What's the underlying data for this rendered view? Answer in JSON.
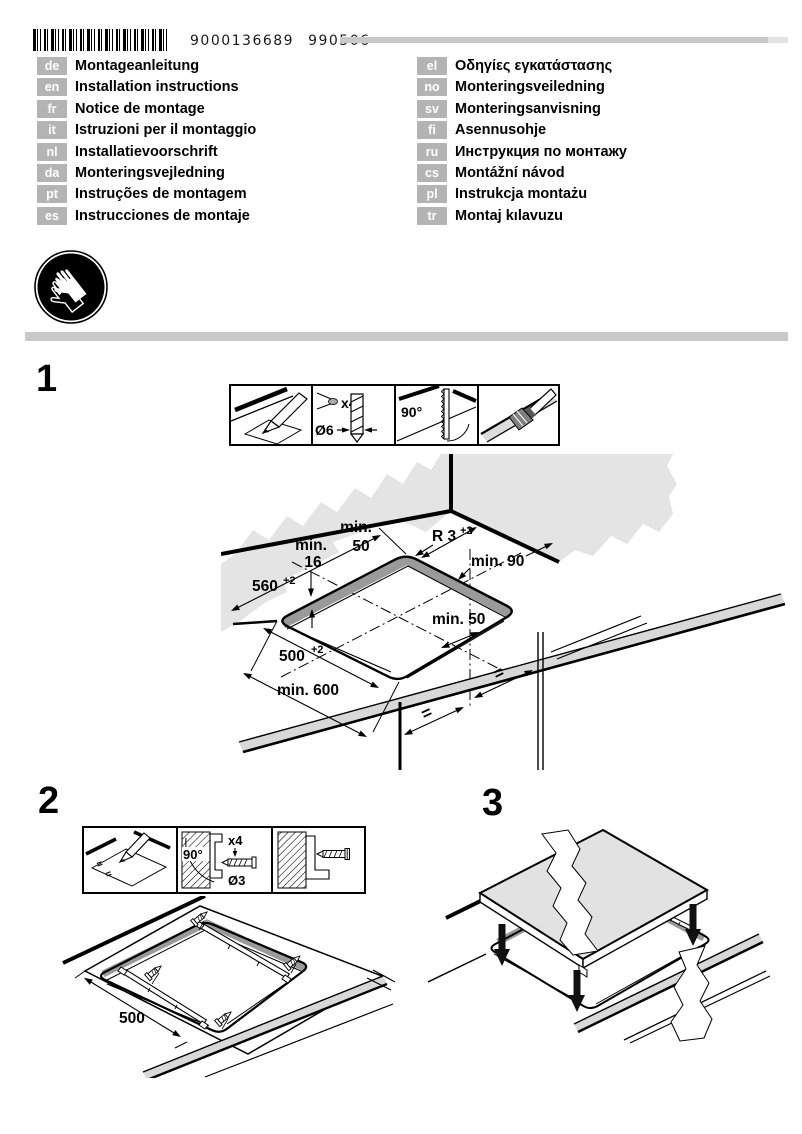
{
  "header": {
    "barcode_number": "9000136689",
    "date_code": "990506",
    "barcode_icon": "barcode-icon"
  },
  "safety": {
    "gloves_icon": "protective-gloves-icon"
  },
  "languages_left": [
    {
      "code": "de",
      "label": "Montageanleitung"
    },
    {
      "code": "en",
      "label": "Installation instructions"
    },
    {
      "code": "fr",
      "label": "Notice de montage"
    },
    {
      "code": "it",
      "label": "Istruzioni per il montaggio"
    },
    {
      "code": "nl",
      "label": "Installatievoorschrift"
    },
    {
      "code": "da",
      "label": "Monteringsvejledning"
    },
    {
      "code": "pt",
      "label": "Instruções de montagem"
    },
    {
      "code": "es",
      "label": "Instrucciones de montaje"
    }
  ],
  "languages_right": [
    {
      "code": "el",
      "label": "Οδηγίες εγκατάστασης"
    },
    {
      "code": "no",
      "label": "Monteringsveiledning"
    },
    {
      "code": "sv",
      "label": "Monteringsanvisning"
    },
    {
      "code": "fi",
      "label": "Asennusohje"
    },
    {
      "code": "ru",
      "label": "Инструкция по монтажу"
    },
    {
      "code": "cs",
      "label": "Montážní návod"
    },
    {
      "code": "pl",
      "label": "Instrukcja montażu"
    },
    {
      "code": "tr",
      "label": "Montaj kılavuzu"
    }
  ],
  "steps": {
    "one": "1",
    "two": "2",
    "three": "3"
  },
  "step1": {
    "toolbox": {
      "count": "x4",
      "drill_diameter": "Ø6",
      "angle": "90°"
    },
    "dims": {
      "min_word_top": "min.",
      "top_value": "50",
      "min_word_left": "min.",
      "left_value": "16",
      "width": "560",
      "width_sup": "+2",
      "radius": "R 3",
      "radius_sup": "+2",
      "min90": "min. 90",
      "min50": "min. 50",
      "depth": "500",
      "depth_sup": "+2",
      "min600": "min. 600",
      "eq_left": "=",
      "eq_right": "="
    }
  },
  "step2": {
    "toolbox": {
      "angle": "90°",
      "count": "x4",
      "drill_diameter": "Ø3",
      "eq1": "=",
      "eq2": "="
    },
    "dims": {
      "width": "500"
    }
  },
  "colors": {
    "badge_bg": "#b4b4b4",
    "gray_bar": "#c9c9c9",
    "wall_gray": "#e4e4e4",
    "cut_edge_band": "#9a9a9a",
    "cooktop_surface": "#e2e2e2",
    "ink": "#000000"
  }
}
